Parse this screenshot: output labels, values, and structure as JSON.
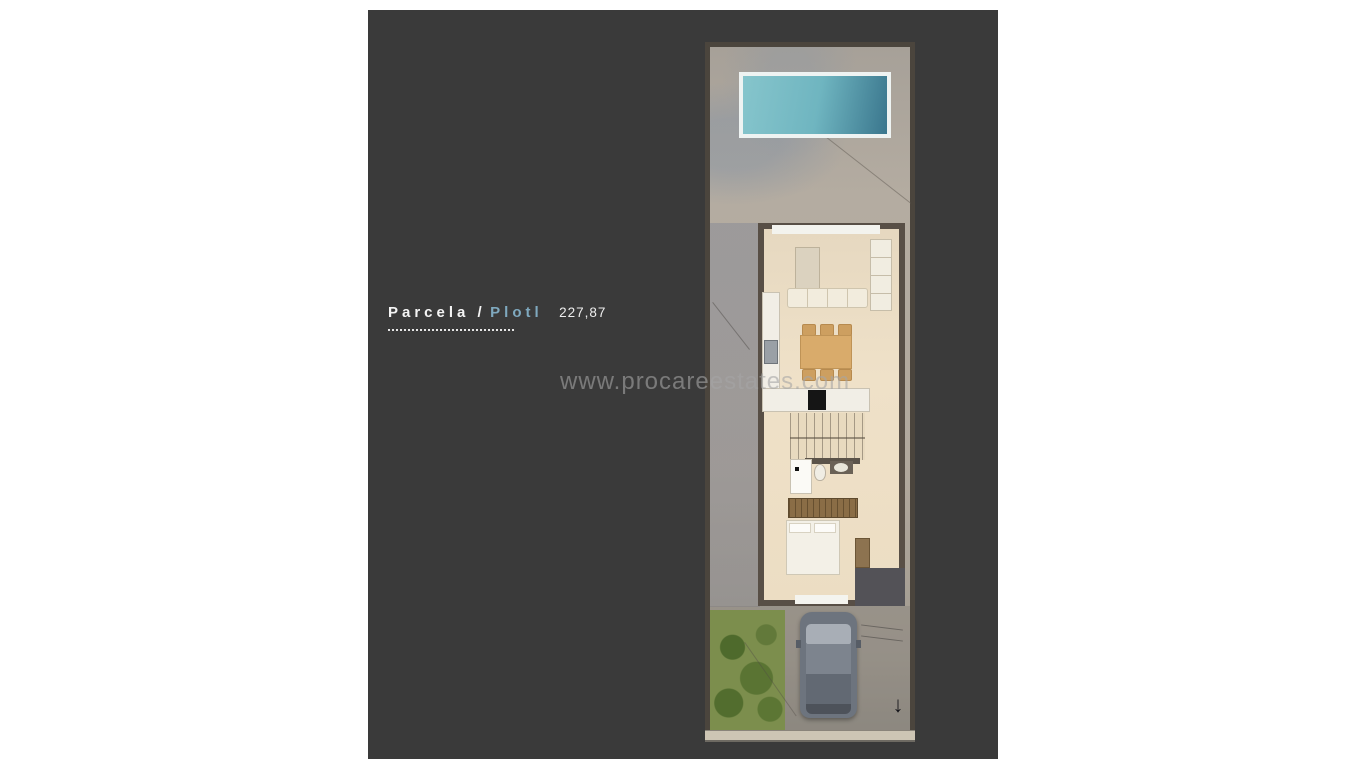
{
  "label": {
    "primary": "Parcela /",
    "secondary": "Plotl",
    "value": "227,87"
  },
  "watermark": {
    "text": "www.procareestates.com"
  },
  "icons": {
    "dimension_arrow": "↓"
  },
  "colors": {
    "page_background": "#ffffff",
    "panel_background": "#3a3a3a",
    "accent_blue": "#7fa9bf",
    "pool_water_light": "#86c5cc",
    "pool_water_dark": "#3a768d",
    "pool_border": "#eef3f2",
    "plot_ground": "#b2a99d",
    "wall": "#584f46",
    "interior_floor": "#ecddc3",
    "furniture_white": "#f1ede1",
    "dining_wood": "#d9ab6b",
    "wardrobe_brown": "#8a6d46",
    "car_body": "#6d747e",
    "garden_green": "#7c8e4d",
    "watermark_gray": "#a6a6a6"
  },
  "plan": {
    "features": [
      "swimming-pool",
      "sun-terrace",
      "living-room",
      "sofa",
      "tv-unit",
      "shelving-unit",
      "dining-table",
      "six-chairs",
      "kitchen-counter",
      "cooktop",
      "staircase",
      "bathroom",
      "shower",
      "toilet",
      "washbasin",
      "wardrobe",
      "bedroom",
      "double-bed",
      "desk",
      "entrance-door",
      "garden",
      "driveway",
      "parked-car"
    ]
  }
}
